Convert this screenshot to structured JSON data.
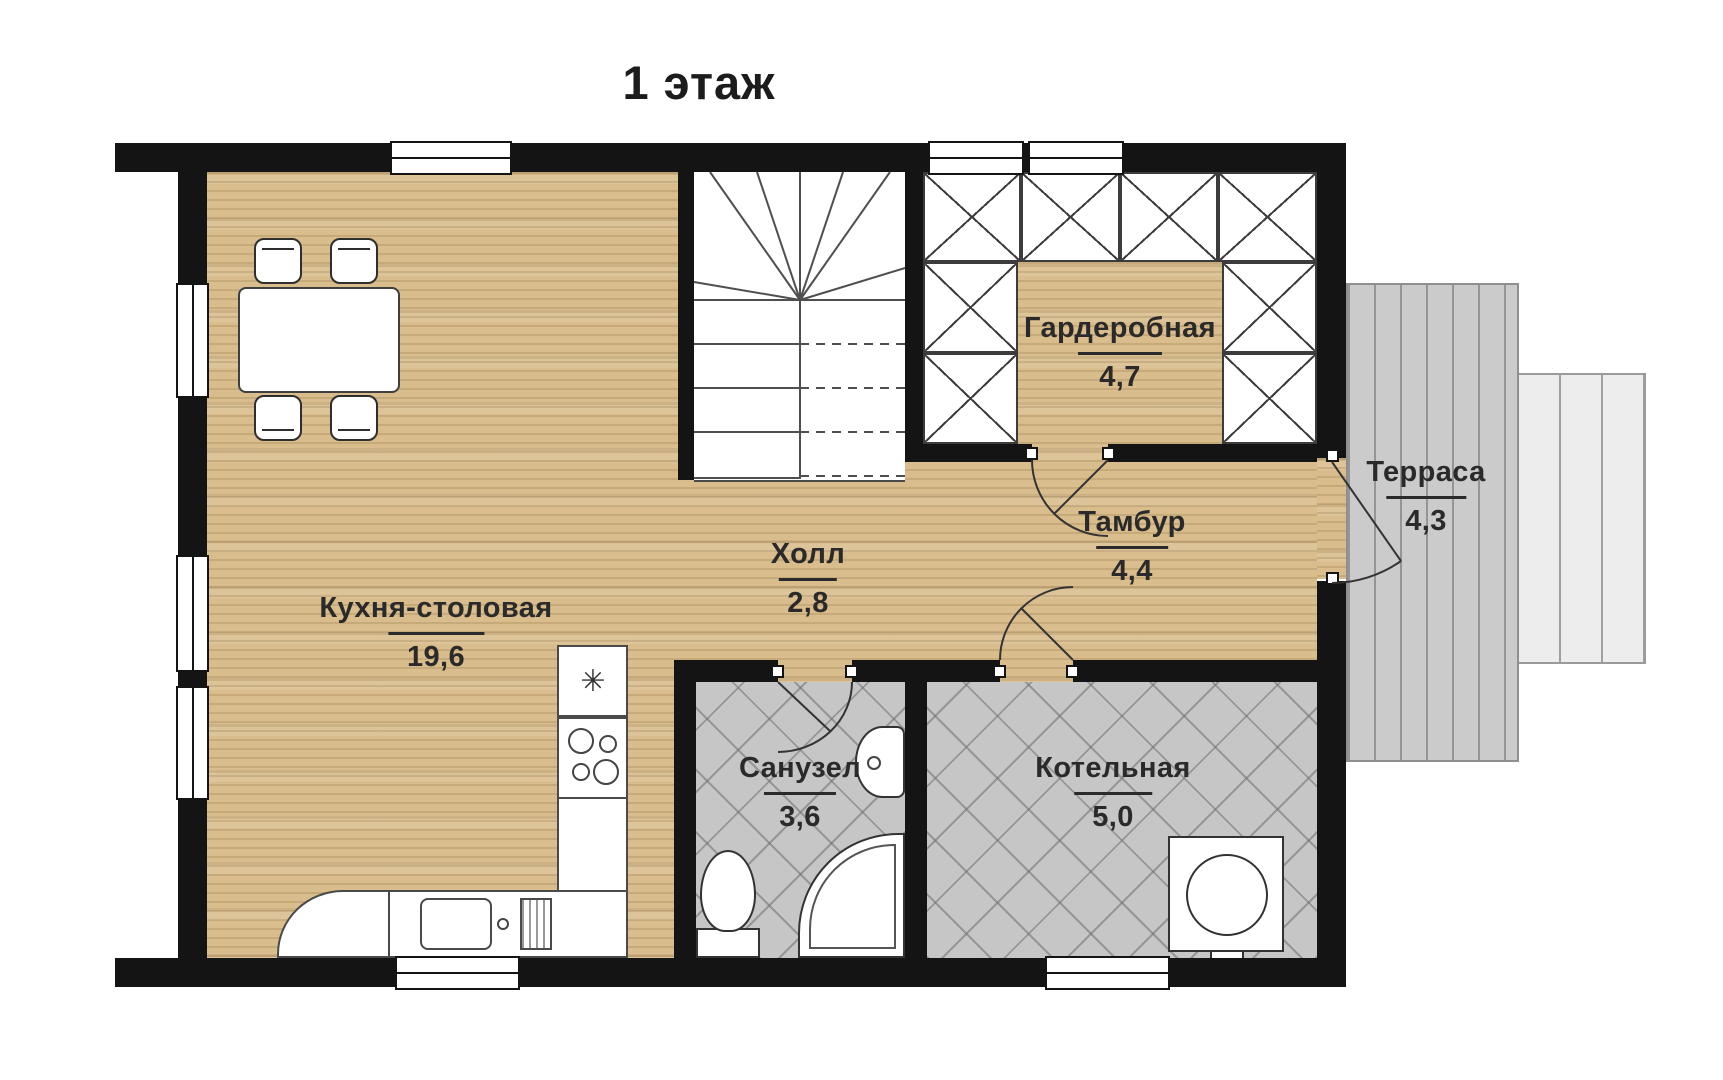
{
  "title": "1 этаж",
  "rooms": [
    {
      "id": "kitchen-dining",
      "name": "Кухня-столовая",
      "area": "19,6"
    },
    {
      "id": "hall",
      "name": "Холл",
      "area": "2,8"
    },
    {
      "id": "tambour",
      "name": "Тамбур",
      "area": "4,4"
    },
    {
      "id": "wardrobe",
      "name": "Гардеробная",
      "area": "4,7"
    },
    {
      "id": "terrace",
      "name": "Терраса",
      "area": "4,3"
    },
    {
      "id": "bathroom",
      "name": "Санузел",
      "area": "3,6"
    },
    {
      "id": "boiler-room",
      "name": "Котельная",
      "area": "5,0"
    }
  ],
  "icons": {
    "fridge_snowflake": "✳"
  },
  "colors": {
    "wall": "#141414",
    "wood_floor": "#d9bd8d",
    "tile_floor": "#c6c6c6",
    "terrace_deck": "#cbcbcb",
    "label_text": "#2a2a2a"
  }
}
